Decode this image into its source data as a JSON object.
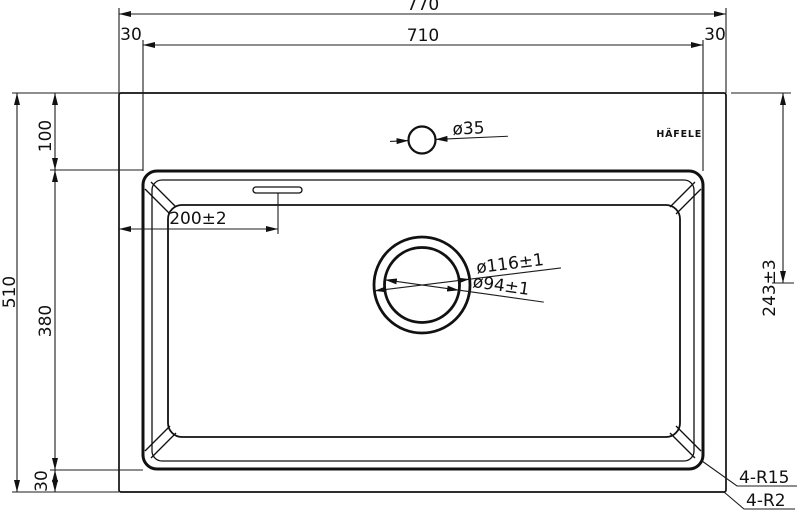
{
  "brand": "HÄFELE",
  "dims": {
    "overall_width": "770",
    "bowl_width": "710",
    "rim_top_left": "30",
    "rim_top_right": "30",
    "overall_height": "510",
    "top_to_bowl": "100",
    "bowl_height": "380",
    "bottom_rim": "30",
    "faucet_hole": "ø35",
    "overflow_offset": "200±2",
    "drain_from_top": "243±3",
    "drain_outer": "ø116±1",
    "drain_inner": "ø94±1",
    "bowl_corner_radius": "4-R15",
    "body_corner_radius": "4-R2"
  },
  "colors": {
    "line": "#111111",
    "background": "#ffffff"
  }
}
